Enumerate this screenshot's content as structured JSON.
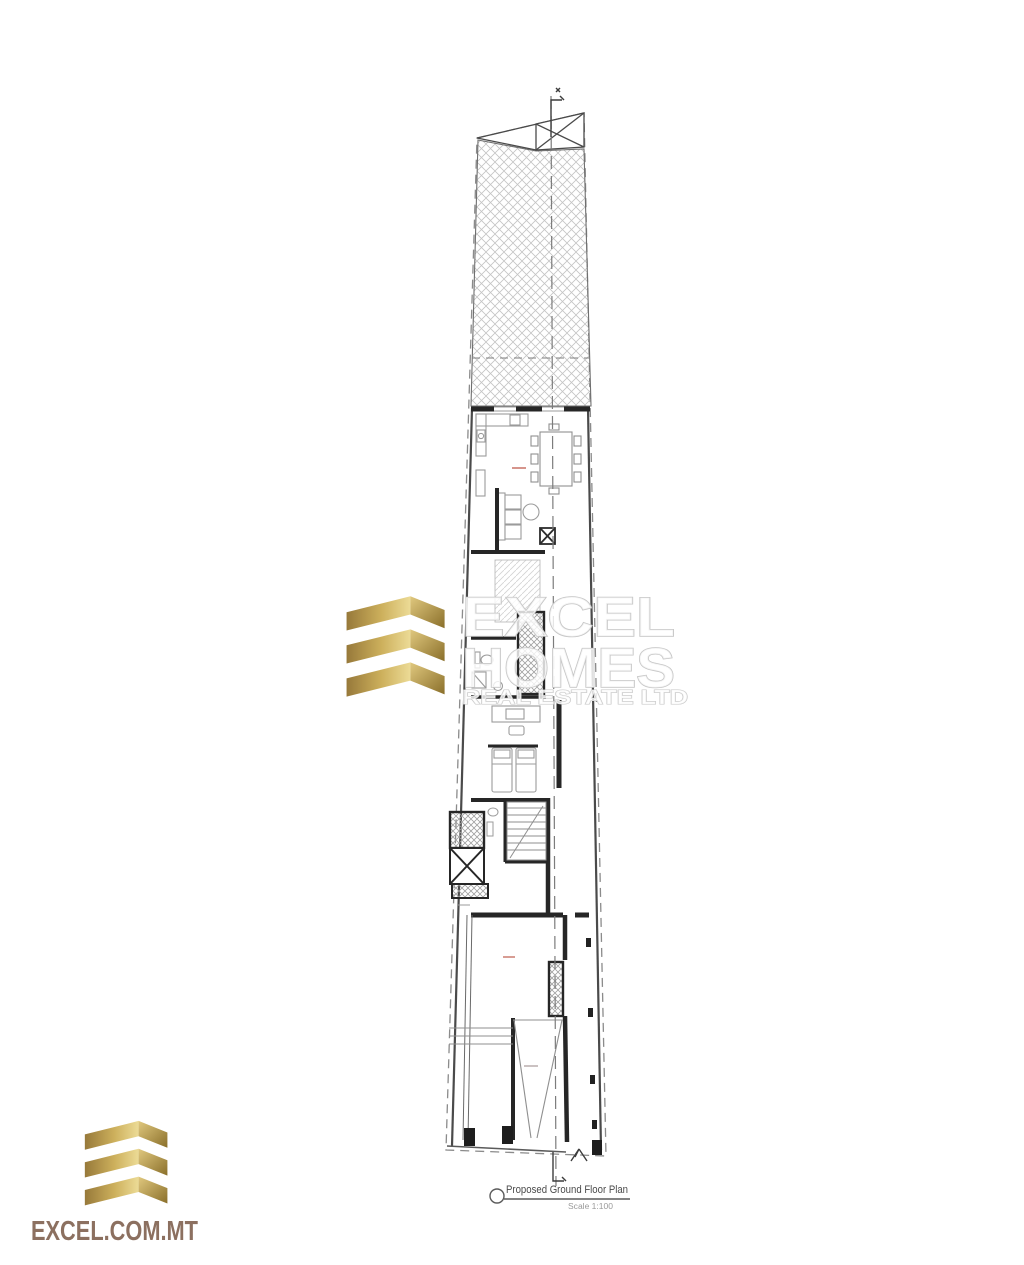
{
  "watermark": {
    "line1": "EXCEL",
    "line2": "HOMES",
    "line3": "REAL ESTATE LTD",
    "logo": "excel-homes-gold-bars-logo",
    "outline_color": "#c6c6c6"
  },
  "footer": {
    "site": "EXCEL.COM.MT",
    "logo": "excel-gold-bars-logo",
    "text_color": "#8c7060"
  },
  "caption": {
    "title": "Proposed Ground Floor Plan",
    "scale": "Scale 1:100"
  },
  "plan": {
    "name": "proposed-ground-floor-plan-drawing",
    "features": [
      "hatched-rear-yard",
      "roof-light-x-box",
      "kitchen-dining",
      "living-area",
      "internal-shaft",
      "bathroom",
      "study",
      "bedroom",
      "staircase",
      "lift-shaft",
      "garage",
      "vehicle-ramp",
      "section-line",
      "entrance-arrow"
    ],
    "colors": {
      "walls": "#262626",
      "thin_lines": "#9b9b9b",
      "hatch": "#c4c4c4",
      "boundary_dash": "#8b8b8b",
      "accent_red": "#c4685a"
    }
  },
  "colors": {
    "background": "#ffffff",
    "gold_dark": "#8a6f2a",
    "gold_mid": "#c9ac55",
    "gold_light": "#ecdb96"
  }
}
